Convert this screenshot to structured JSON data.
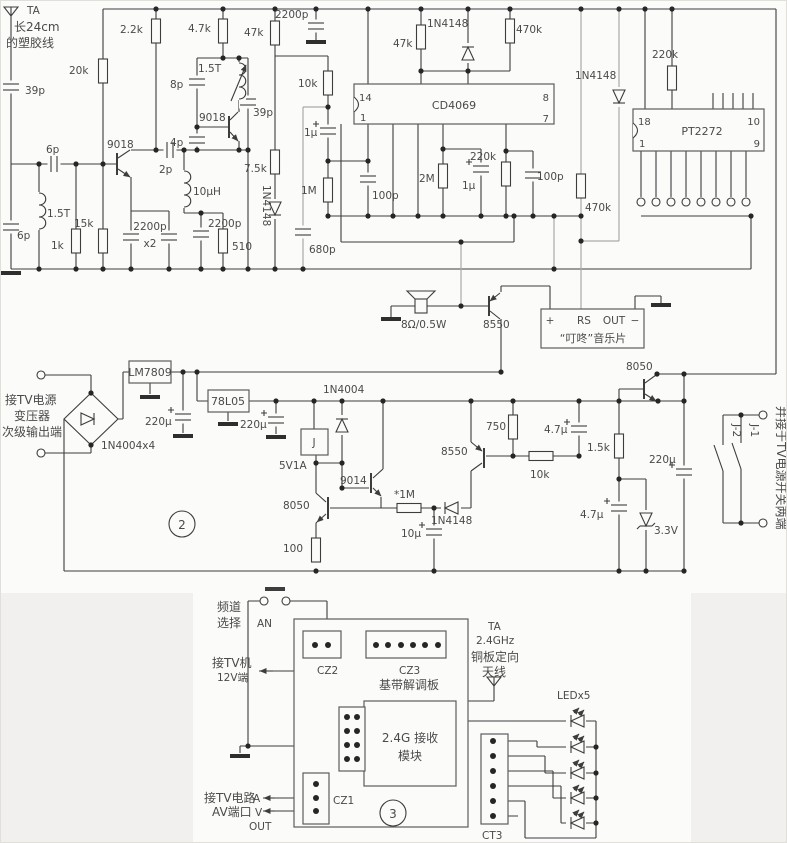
{
  "diagram": {
    "kind": "circuit-schematic",
    "language": "zh-CN",
    "description": "2.4G wireless TV AV transmitter/receiver schematic with chime and power supply"
  },
  "colors": {
    "wire": "#3d3d3d",
    "wire_light": "#a9a9a9",
    "background": "#fbfbfa",
    "panel_gray": "#f1f0ee",
    "text": "#4a4a4a"
  },
  "rf": {
    "ta": "TA",
    "ta2": "长24cm",
    "ta3": "的塑胶线",
    "c39p": "39p",
    "c6p_se": "6p",
    "l15t": "1.5T",
    "c6p_sh": "6p",
    "r1k": "1k",
    "r15k": "15k",
    "r20k": "20k",
    "r22k": "2.2k",
    "q1": "9018",
    "c2200x2": "2200p",
    "x2": "x2",
    "c2p": "2p",
    "l10uh": "10μH",
    "c2200b": "2200p",
    "r510": "510",
    "c4p": "4p",
    "c8p": "8p",
    "l15t2": "1.5T",
    "r47k": "4.7k",
    "q2": "9018",
    "c39pb": "39p",
    "r75k": "7.5k",
    "d1": "1N4148",
    "r47kb": "47k",
    "c2200c": "2200p"
  },
  "dec": {
    "r10k": "10k",
    "c1u": "1μ",
    "r1m": "1M",
    "c680p": "680p",
    "c100p": "100p",
    "r47kc": "47k",
    "d2": "1N4148",
    "r470k": "470k",
    "ic1": "CD4069",
    "p14": "14",
    "p1": "1",
    "p8": "8",
    "p7": "7",
    "r2m": "2M",
    "c1ub": "1μ",
    "r220k": "220k",
    "c100pb": "100p",
    "r470kb": "470k",
    "d3": "1N4148",
    "r220kb": "220k",
    "ic2": "PT2272",
    "p18": "18",
    "p1b": "1",
    "p10": "10",
    "p9": "9"
  },
  "chime": {
    "spk": "8Ω/0.5W",
    "q3": "8550",
    "plus": "+",
    "rs": "RS",
    "out": "OUT",
    "minus": "−",
    "name": "“叮咚”音乐片"
  },
  "pwr": {
    "in1": "接TV电源",
    "in2": "变压器",
    "in3": "次级输出端",
    "bridge": "1N4004x4",
    "vr1": "LM7809",
    "c220a": "220μ",
    "vr2": "78L05",
    "c220b": "220μ",
    "relay": "J",
    "fuse": "5V1A",
    "d4": "1N4004",
    "q5": "8050",
    "r100": "100",
    "sec": "2",
    "q6": "9014",
    "r1ms": "*1M",
    "d5": "1N4148",
    "q7": "8550",
    "r750": "750",
    "r10kb": "10k",
    "c47a": "4.7μ",
    "c10u": "10μ",
    "q8": "8050",
    "r15kb": "1.5k",
    "c220c": "220μ",
    "c47b": "4.7μ",
    "zd": "3.3V",
    "j1": "J-1",
    "j2": "J-2",
    "side": "并接于TV电源开关两端"
  },
  "av": {
    "ch1": "频道",
    "ch2": "选择",
    "an": "AN",
    "cz2": "CZ2",
    "cz3": "CZ3",
    "board": "基带解调板",
    "tv1": "接TV机",
    "tv2": "12V端",
    "ant1": "TA",
    "ant2": "2.4GHz",
    "ant3": "铜板定向",
    "ant4": "天线",
    "mod1": "2.4G 接收",
    "mod2": "模块",
    "led": "LEDx5",
    "ct3": "CT3",
    "av1": "接TV电路",
    "av2": "AV端口",
    "a": "A",
    "v": "V",
    "outp": "OUT",
    "cz1": "CZ1",
    "sec": "3"
  }
}
